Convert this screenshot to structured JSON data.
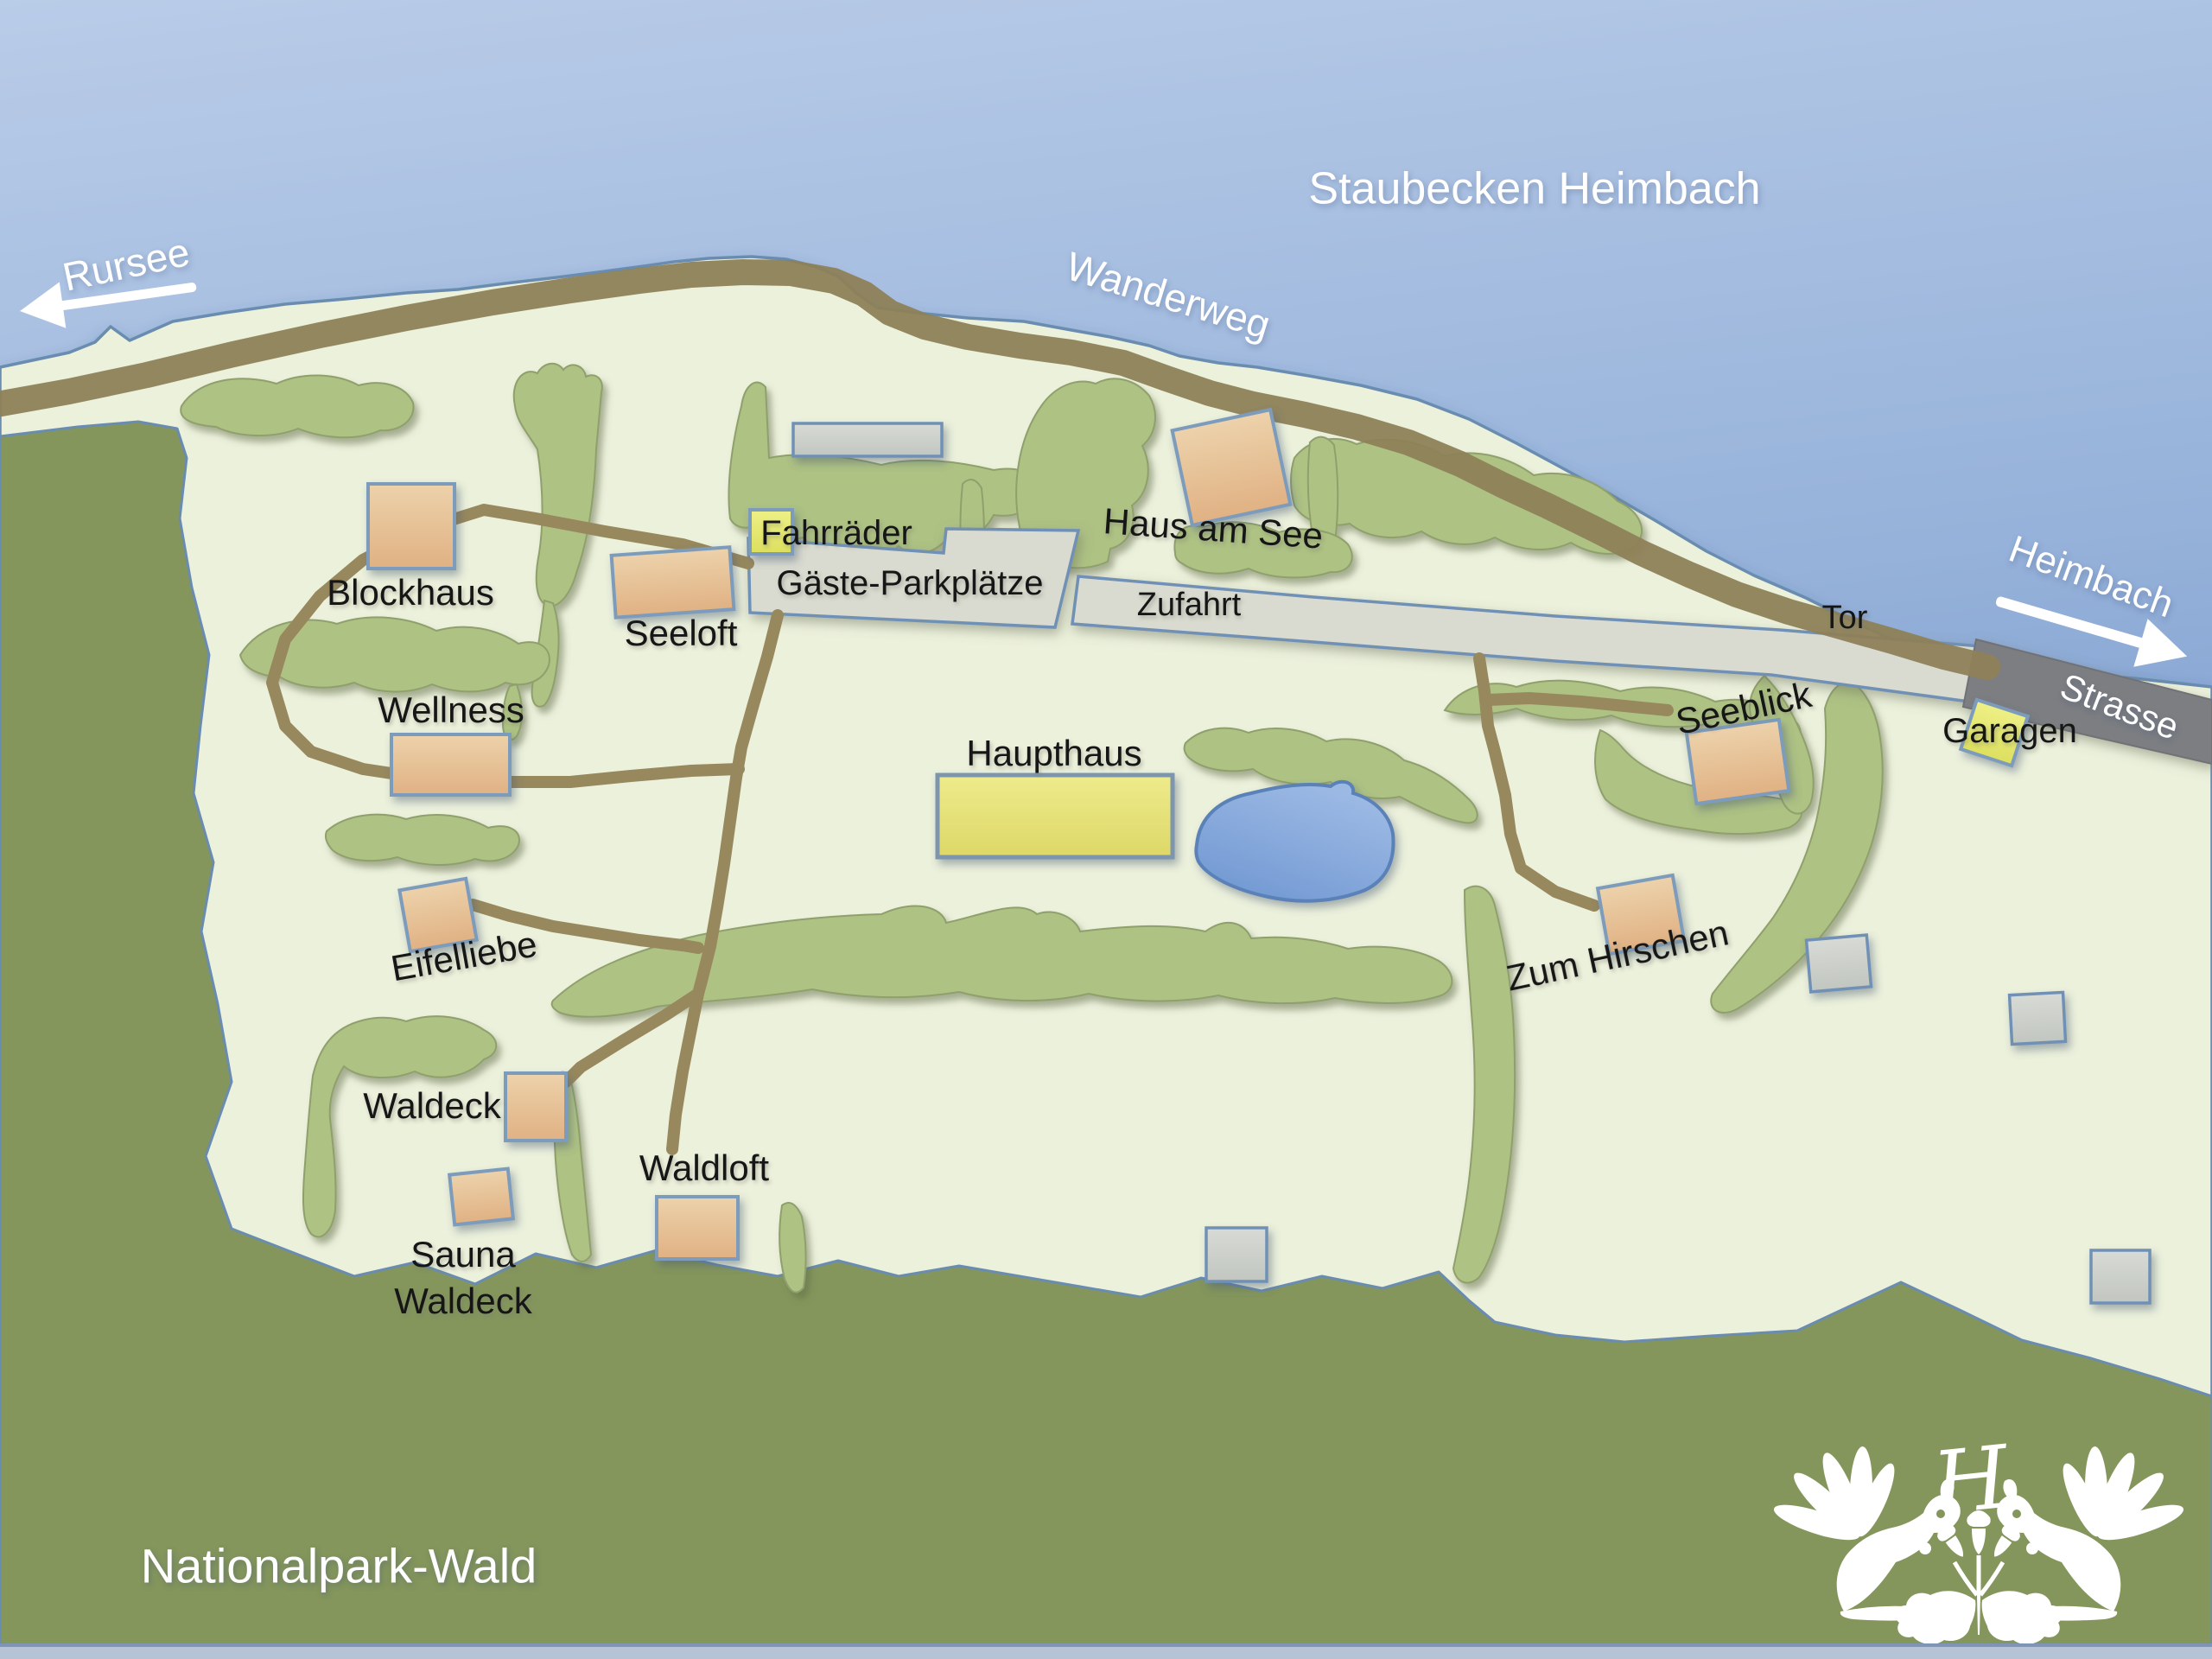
{
  "map_title": "Staubecken Heimbach",
  "water": {
    "label": "Staubecken Heimbach"
  },
  "forest": {
    "label": "Nationalpark-Wald"
  },
  "directions": {
    "rursee": "Rursee",
    "heimbach": "Heimbach"
  },
  "routes": {
    "wanderweg": "Wanderweg",
    "zufahrt": "Zufahrt",
    "strasse": "Strasse",
    "tor": "Tor"
  },
  "areas": {
    "parking": "Gäste-Parkplätze"
  },
  "buildings": {
    "blockhaus": {
      "label": "Blockhaus"
    },
    "seeloft": {
      "label": "Seeloft"
    },
    "wellness": {
      "label": "Wellness"
    },
    "eifelliebe": {
      "label": "Eifelliebe"
    },
    "waldeck": {
      "label": "Waldeck"
    },
    "sauna_waldeck": {
      "label_line1": "Sauna",
      "label_line2": "Waldeck"
    },
    "waldloft": {
      "label": "Waldloft"
    },
    "haupthaus": {
      "label": "Haupthaus"
    },
    "haus_am_see": {
      "label": "Haus am See"
    },
    "zum_hirschen": {
      "label": "Zum Hirschen"
    },
    "seeblick": {
      "label": "Seeblick"
    },
    "garagen": {
      "label": "Garagen"
    },
    "fahrraeder": {
      "label": "Fahrräder"
    }
  },
  "colors": {
    "water_top": "#b9cce8",
    "water_deep": "#6286c0",
    "land": "#ecf1dc",
    "forest": "#84965c",
    "hedge": "#aec284",
    "trail": "#8e8158",
    "road_light": "#d9dbd0",
    "road_dark": "#7b7e82",
    "building_tan": "#e4bc8f",
    "building_yellow": "#e9e77d",
    "building_lime": "#e6e86e",
    "building_gray": "#ccd0ca",
    "pond": "#7ba1d8",
    "outline_blue": "#6a8cb0"
  }
}
